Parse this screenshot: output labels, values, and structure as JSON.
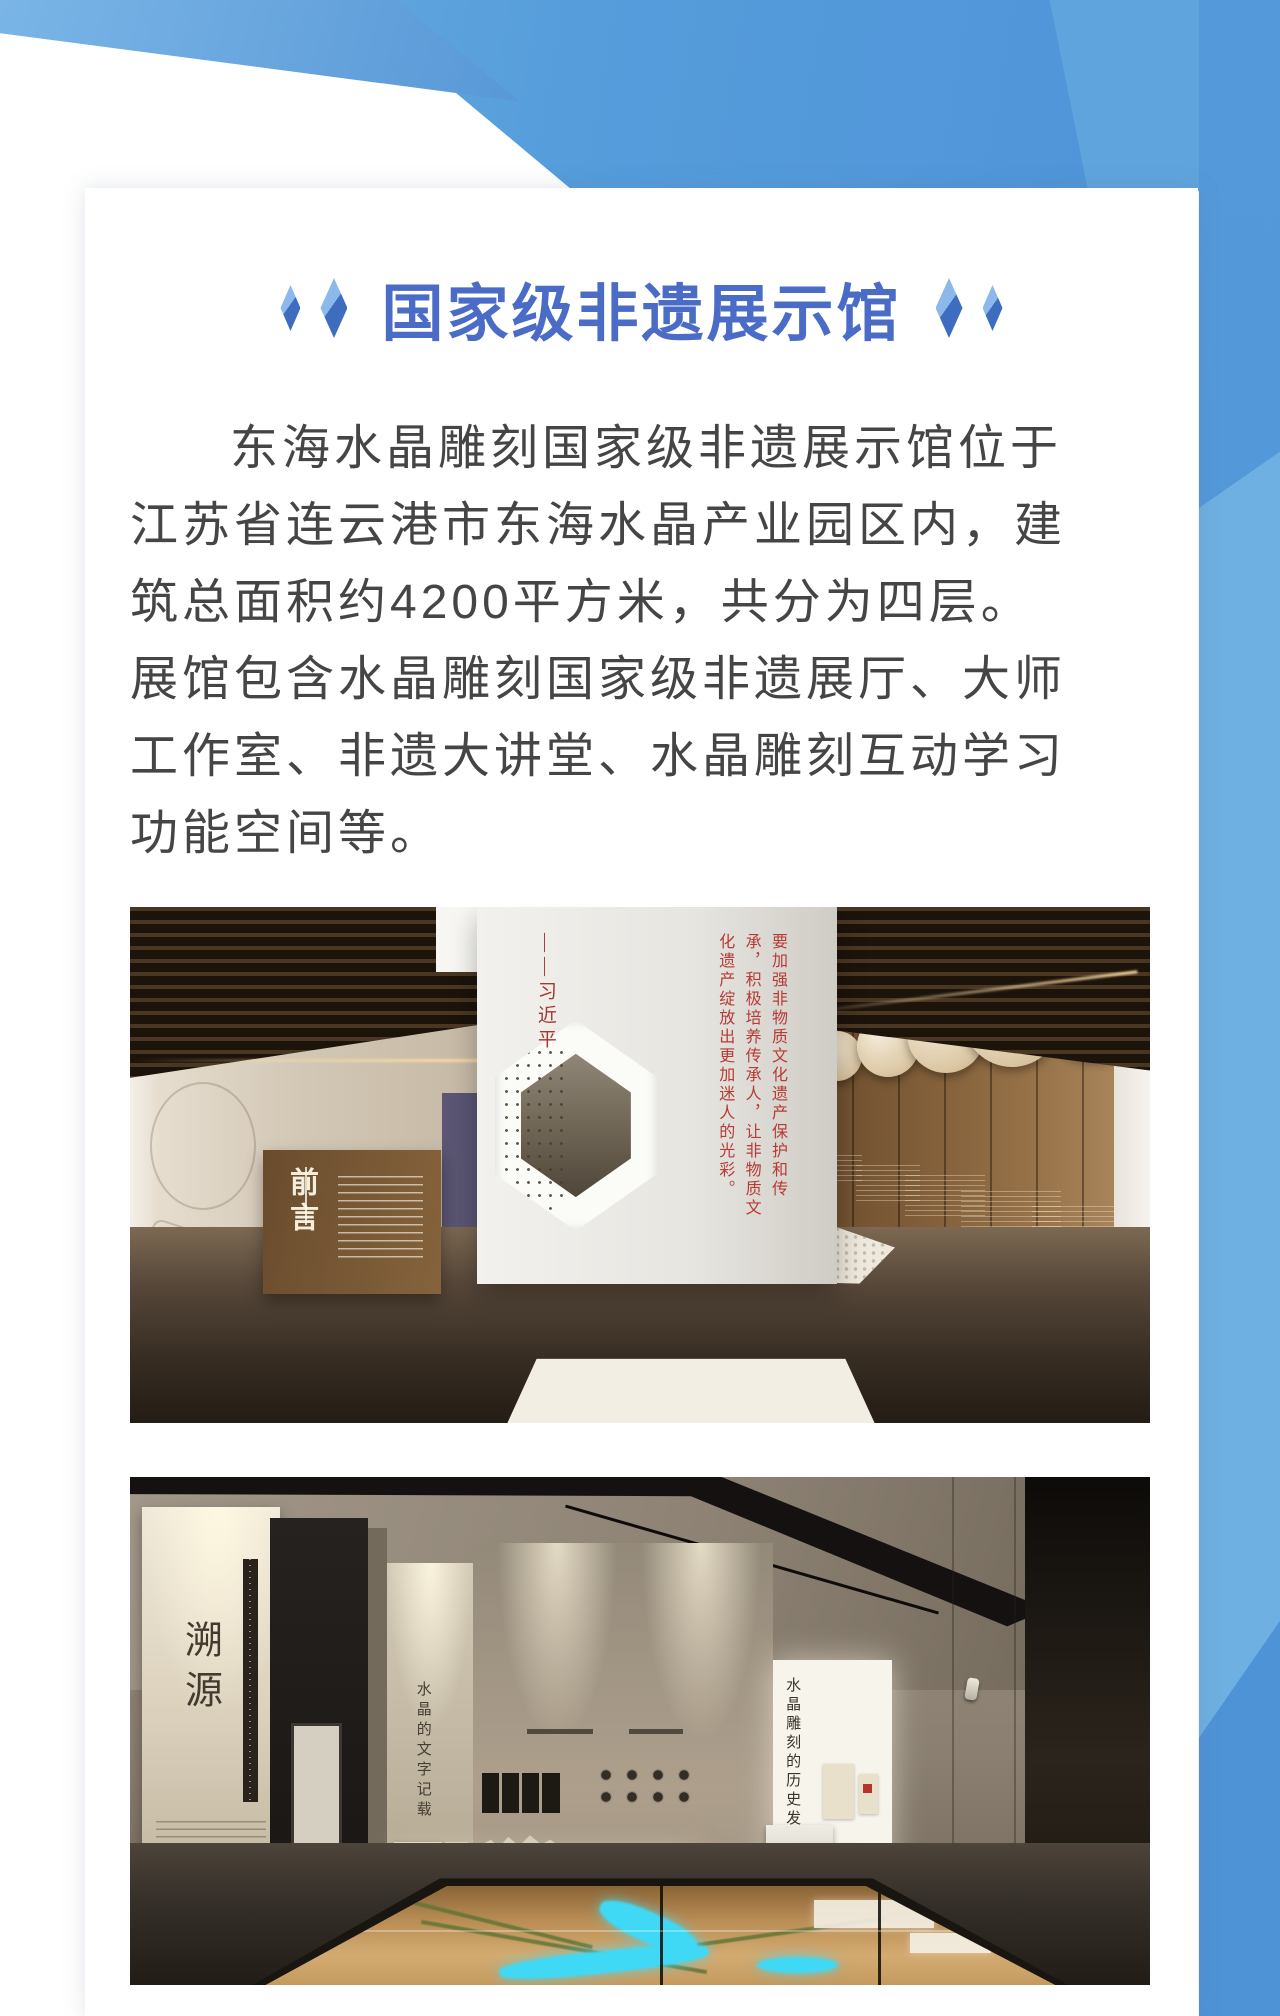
{
  "header": {
    "title": "国家级非遗展示馆"
  },
  "intro": {
    "lines": [
      "东海水晶雕刻国家级非遗展示馆位于",
      "江苏省连云港市东海水晶产业园区内，建",
      "筑总面积约4200平方米，共分为四层。",
      "展馆包含水晶雕刻国家级非遗展厅、大师",
      "工作室、非遗大讲堂、水晶雕刻互动学习",
      "功能空间等。"
    ]
  },
  "photo1": {
    "foreword_label": "前言",
    "quote": "要加强非物质文化遗产保护和传承，积极培养传承人，让非物质文化遗产绽放出更加迷人的光彩。",
    "signature": "——习近平"
  },
  "photo2": {
    "panel_left": "溯源",
    "panel_mid": "水晶的文字记载",
    "plaque": "山海经",
    "panel_right": "水晶雕刻的历史发展"
  },
  "colors": {
    "accent_blue": "#4a6cc6",
    "header_blue": "#4e92d8",
    "header_blue_light": "#6fb0e1",
    "band_blue": "#4f93d7",
    "quote_red": "#b63a35",
    "body_text": "#454545"
  }
}
